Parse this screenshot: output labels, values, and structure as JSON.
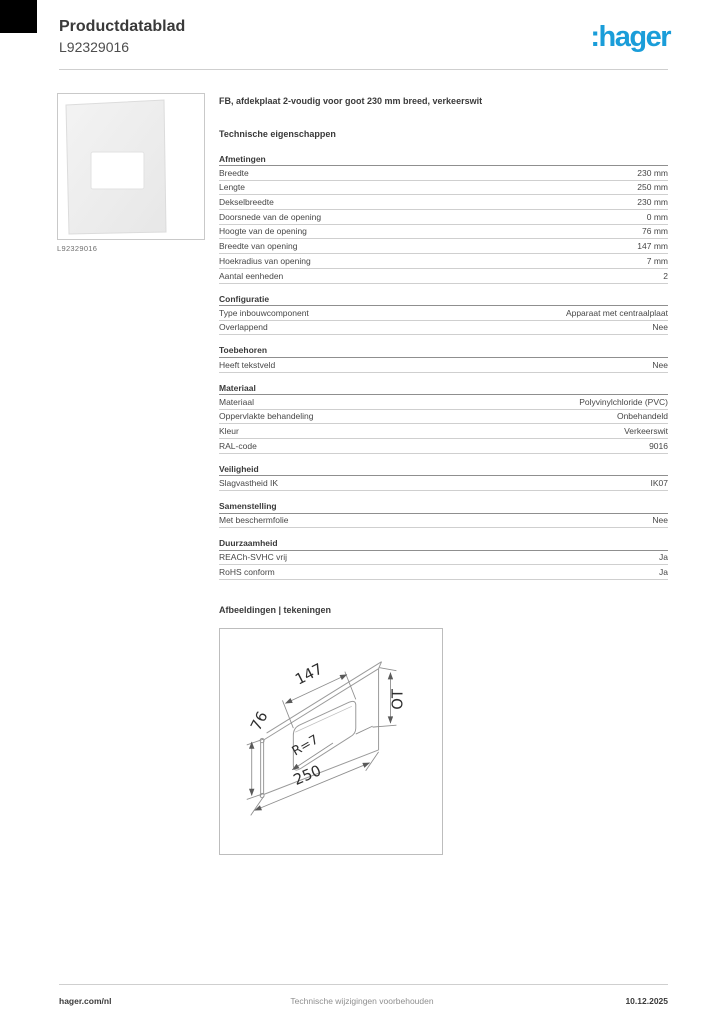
{
  "page": {
    "header": {
      "title": "Productdatablad",
      "subtitle": "L92329016",
      "logo_text": ":hager",
      "logo_color": "#1a9dd9"
    },
    "product": {
      "image_caption": "L92329016"
    },
    "content": {
      "product_title": "FB, afdekplaat 2-voudig voor goot 230 mm breed, verkeerswit",
      "section_heading": "Technische eigenschappen",
      "sections": [
        {
          "title": "Afmetingen",
          "rows": [
            [
              "Breedte",
              "230 mm"
            ],
            [
              "Lengte",
              "250 mm"
            ],
            [
              "Dekselbreedte",
              "230 mm"
            ],
            [
              "Doorsnede van de opening",
              "0 mm"
            ],
            [
              "Hoogte van de opening",
              "76 mm"
            ],
            [
              "Breedte van opening",
              "147 mm"
            ],
            [
              "Hoekradius van opening",
              "7 mm"
            ],
            [
              "Aantal eenheden",
              "2"
            ]
          ]
        },
        {
          "title": "Configuratie",
          "rows": [
            [
              "Type inbouwcomponent",
              "Apparaat met centraalplaat"
            ],
            [
              "Overlappend",
              "Nee"
            ]
          ]
        },
        {
          "title": "Toebehoren",
          "rows": [
            [
              "Heeft tekstveld",
              "Nee"
            ]
          ]
        },
        {
          "title": "Materiaal",
          "rows": [
            [
              "Materiaal",
              "Polyvinylchloride (PVC)"
            ],
            [
              "Oppervlakte behandeling",
              "Onbehandeld"
            ],
            [
              "Kleur",
              "Verkeerswit"
            ],
            [
              "RAL-code",
              "9016"
            ]
          ]
        },
        {
          "title": "Veiligheid",
          "rows": [
            [
              "Slagvastheid IK",
              "IK07"
            ]
          ]
        },
        {
          "title": "Samenstelling",
          "rows": [
            [
              "Met beschermfolie",
              "Nee"
            ]
          ]
        },
        {
          "title": "Duurzaamheid",
          "rows": [
            [
              "REACh-SVHC vrij",
              "Ja"
            ],
            [
              "RoHS conform",
              "Ja"
            ]
          ]
        }
      ],
      "drawings_heading": "Afbeeldingen | tekeningen",
      "drawing_labels": {
        "opening_width": "147",
        "opening_height": "76",
        "corner_radius": "R=7",
        "length": "250",
        "side": "OT"
      }
    },
    "footer": {
      "left": "hager.com/nl",
      "center": "Technische wijzigingen voorbehouden",
      "right": "10.12.2025"
    }
  }
}
